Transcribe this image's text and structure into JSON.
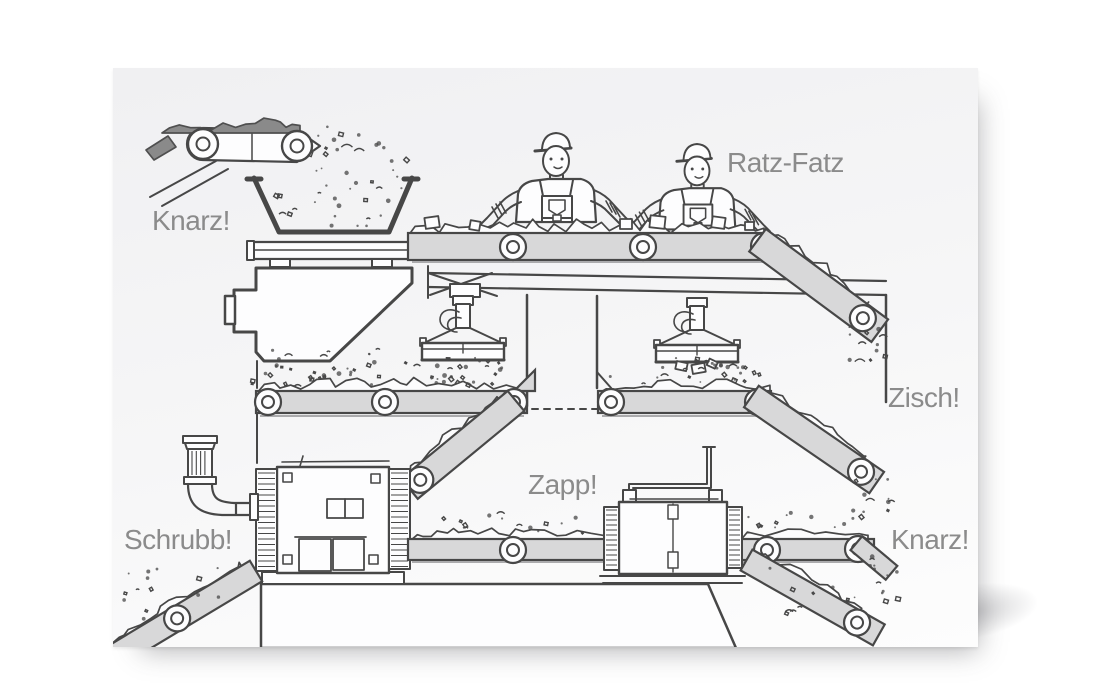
{
  "labels": {
    "knarz_top": "Knarz!",
    "ratz_fatz": "Ratz-Fatz",
    "zisch": "Zisch!",
    "zapp": "Zapp!",
    "schrubb": "Schrubb!",
    "knarz_bottom": "Knarz!"
  },
  "colors": {
    "page_bg": "#ffffff",
    "card_bg_top": "#f0f0f2",
    "card_bg_bottom": "#fdfdfd",
    "ink": "#474747",
    "belt": "#d8d8d9",
    "label": "#8b8b8b",
    "material": "#8a8a8a"
  }
}
